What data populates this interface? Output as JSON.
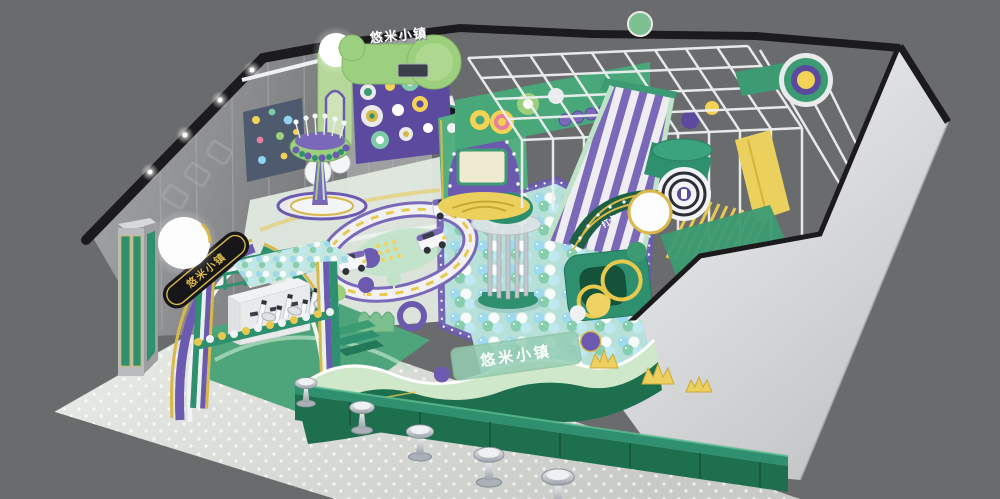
{
  "scene": {
    "description": "3D cutaway render of an indoor children's soft-play playground",
    "brand_name": "悠米小镇",
    "signs": {
      "top_sign": "悠米小镇",
      "entrance_arch": "悠米小镇",
      "front_glass_panel": "悠米小镇",
      "checkin_arch": "打卡"
    },
    "counts": {
      "bar_stools": 5,
      "toy_cars": 3,
      "turnstile_gates": 3
    },
    "palette": {
      "background": "#6a6b6d",
      "left_wall_gray": "#8f9193",
      "shell_white": "#e9eaec",
      "trim_black": "#1b1b1d",
      "green_dark": "#1d6f4e",
      "green_mid": "#3c9b72",
      "green_light": "#9ccf7e",
      "green_pale": "#cfe8c9",
      "purple": "#6c5ab0",
      "purple_deep": "#5b4a9e",
      "yellow": "#f2d355",
      "gold": "#d9b84a",
      "ball_blue": "#9fd9ee",
      "ball_green": "#86cfae",
      "floor_mat_gray": "#dcdeda",
      "stool_silver": "#c9cdd3"
    }
  }
}
